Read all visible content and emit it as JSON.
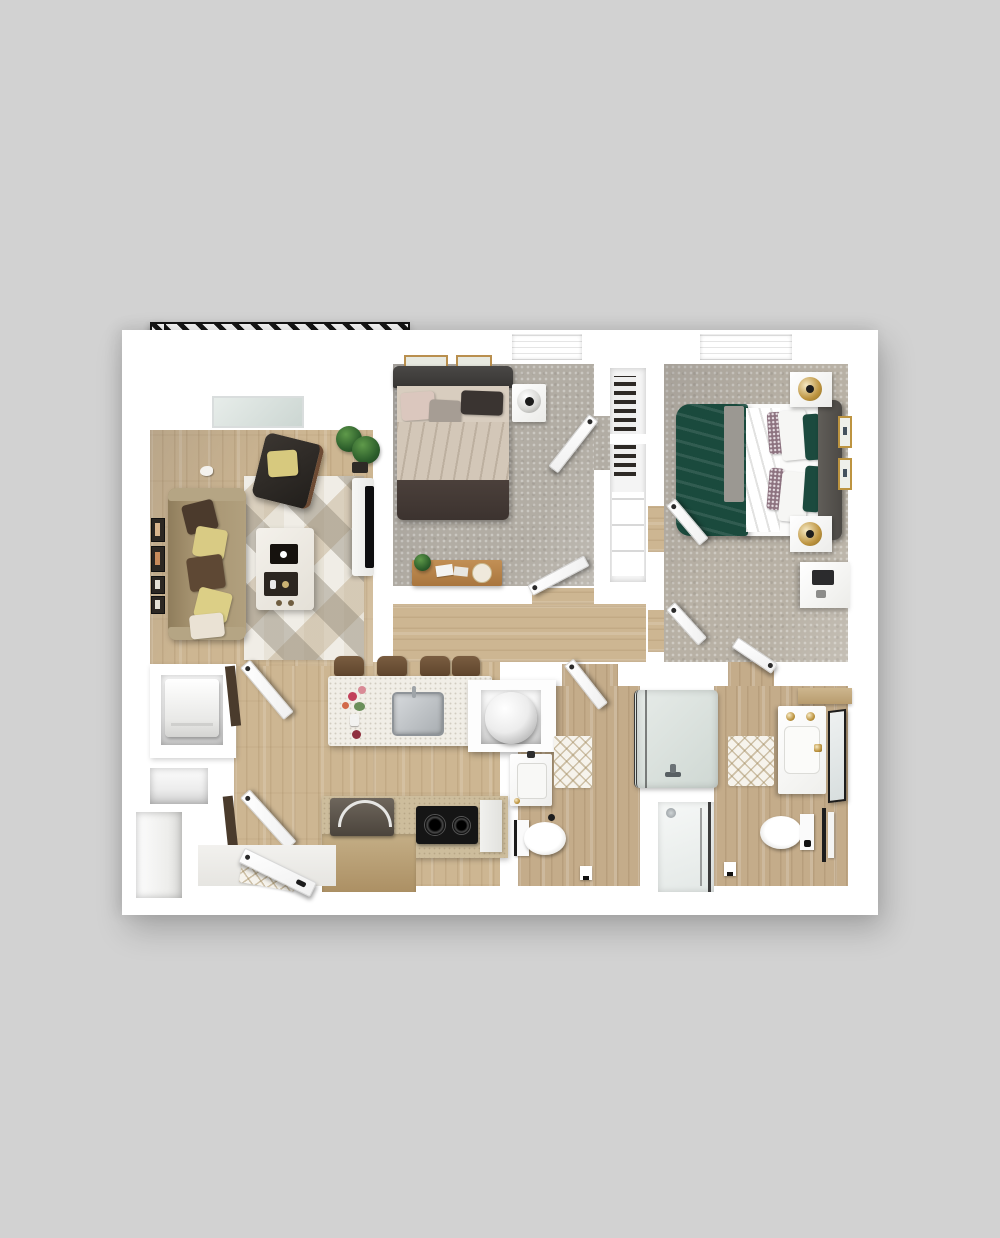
{
  "title": "2 Bedroom / 2 Bath Apartment — 3D Floor Plan (top-down render)",
  "palette": {
    "bg": "#d2d2d2",
    "wall": "#ffffff",
    "wood": "#cdb692",
    "woodBath": "#c4ac8a",
    "carpet1": "#b2ada4",
    "carpet2": "#b8b1a5",
    "balcony": "#c7cbce",
    "rug": "#e8e3d8",
    "island": "#f1eee7",
    "sofa": "#a5926f",
    "bed1Duvet": "#d8cdbf",
    "bed1Foot": "#463c38",
    "bed2Green": "#1a4a3d",
    "gold": "#bd9440",
    "glassFrame": "#3a3a3a",
    "hatch": "#161616"
  },
  "rooms": {
    "balcony": {
      "label": "Balcony",
      "items": [
        {
          "name": "patio-table",
          "label": "Round patio table with two chairs"
        },
        {
          "name": "planter",
          "label": "Planter box with greenery"
        }
      ]
    },
    "living_room": {
      "label": "Living Room",
      "items": [
        {
          "name": "sofa",
          "label": "Three-seat sofa with accent pillows"
        },
        {
          "name": "armchair",
          "label": "Dark accent armchair with yellow pillow"
        },
        {
          "name": "coffee-table",
          "label": "White coffee table with serving trays"
        },
        {
          "name": "area-rug",
          "label": "Geometric triangle area rug"
        },
        {
          "name": "tv-console",
          "label": "TV on media console"
        },
        {
          "name": "floor-plant",
          "label": "Potted fiddle-leaf plant"
        },
        {
          "name": "gallery-frames",
          "label": "Gallery wall frames"
        }
      ]
    },
    "bedroom_1": {
      "label": "Bedroom 1",
      "items": [
        {
          "name": "bed",
          "label": "Queen bed with cream duvet and dark footboard"
        },
        {
          "name": "nightstand",
          "label": "Nightstand with sphere lamp"
        },
        {
          "name": "bench",
          "label": "Wood bench with plant and books"
        },
        {
          "name": "closet",
          "label": "Reach-in closet with hanging clothes"
        },
        {
          "name": "wall-art",
          "label": "Two framed prints above headboard"
        }
      ]
    },
    "bedroom_2": {
      "label": "Bedroom 2",
      "items": [
        {
          "name": "bed",
          "label": "Queen bed with green duvet and gray headboard"
        },
        {
          "name": "nightstand-a",
          "label": "Nightstand with brass lamp (window side)"
        },
        {
          "name": "nightstand-b",
          "label": "Nightstand with brass lamp (door side)"
        },
        {
          "name": "desk",
          "label": "White desk with laptop"
        },
        {
          "name": "wall-art",
          "label": "Two brass framed prints"
        }
      ]
    },
    "kitchen": {
      "label": "Kitchen",
      "items": [
        {
          "name": "island",
          "label": "Quartz island with stainless sink and flowers"
        },
        {
          "name": "stools",
          "label": "Four wood counter stools"
        },
        {
          "name": "cooktop",
          "label": "Black two-burner cooktop"
        },
        {
          "name": "counter",
          "label": "Wood base cabinets and counter"
        },
        {
          "name": "microwave",
          "label": "Countertop appliance with handle"
        }
      ]
    },
    "laundry": {
      "label": "Laundry Nook",
      "items": [
        {
          "name": "washer-dryer",
          "label": "Stacked washer / dryer unit"
        }
      ]
    },
    "bath_1": {
      "label": "Bathroom 1",
      "items": [
        {
          "name": "vanity",
          "label": "Single-sink vanity"
        },
        {
          "name": "toilet",
          "label": "Toilet"
        },
        {
          "name": "tub",
          "label": "Glass-front soaking tub"
        },
        {
          "name": "bath-mat",
          "label": "Diamond lattice bath mat"
        }
      ]
    },
    "bath_2": {
      "label": "Bathroom 2",
      "items": [
        {
          "name": "vanity",
          "label": "Vanity with brass fixtures and leaning mirror"
        },
        {
          "name": "toilet",
          "label": "Toilet with towel bar"
        },
        {
          "name": "shower",
          "label": "Walk-in glass shower"
        },
        {
          "name": "bath-mat",
          "label": "Diamond lattice bath mat"
        }
      ]
    },
    "entry": {
      "label": "Entry",
      "items": [
        {
          "name": "entry-door",
          "label": "Entry door (shown open)"
        },
        {
          "name": "doormat",
          "label": "Door mat"
        },
        {
          "name": "coat-closet",
          "label": "Coat closet"
        },
        {
          "name": "utility-closet",
          "label": "Utility closet with water heater"
        }
      ]
    }
  }
}
